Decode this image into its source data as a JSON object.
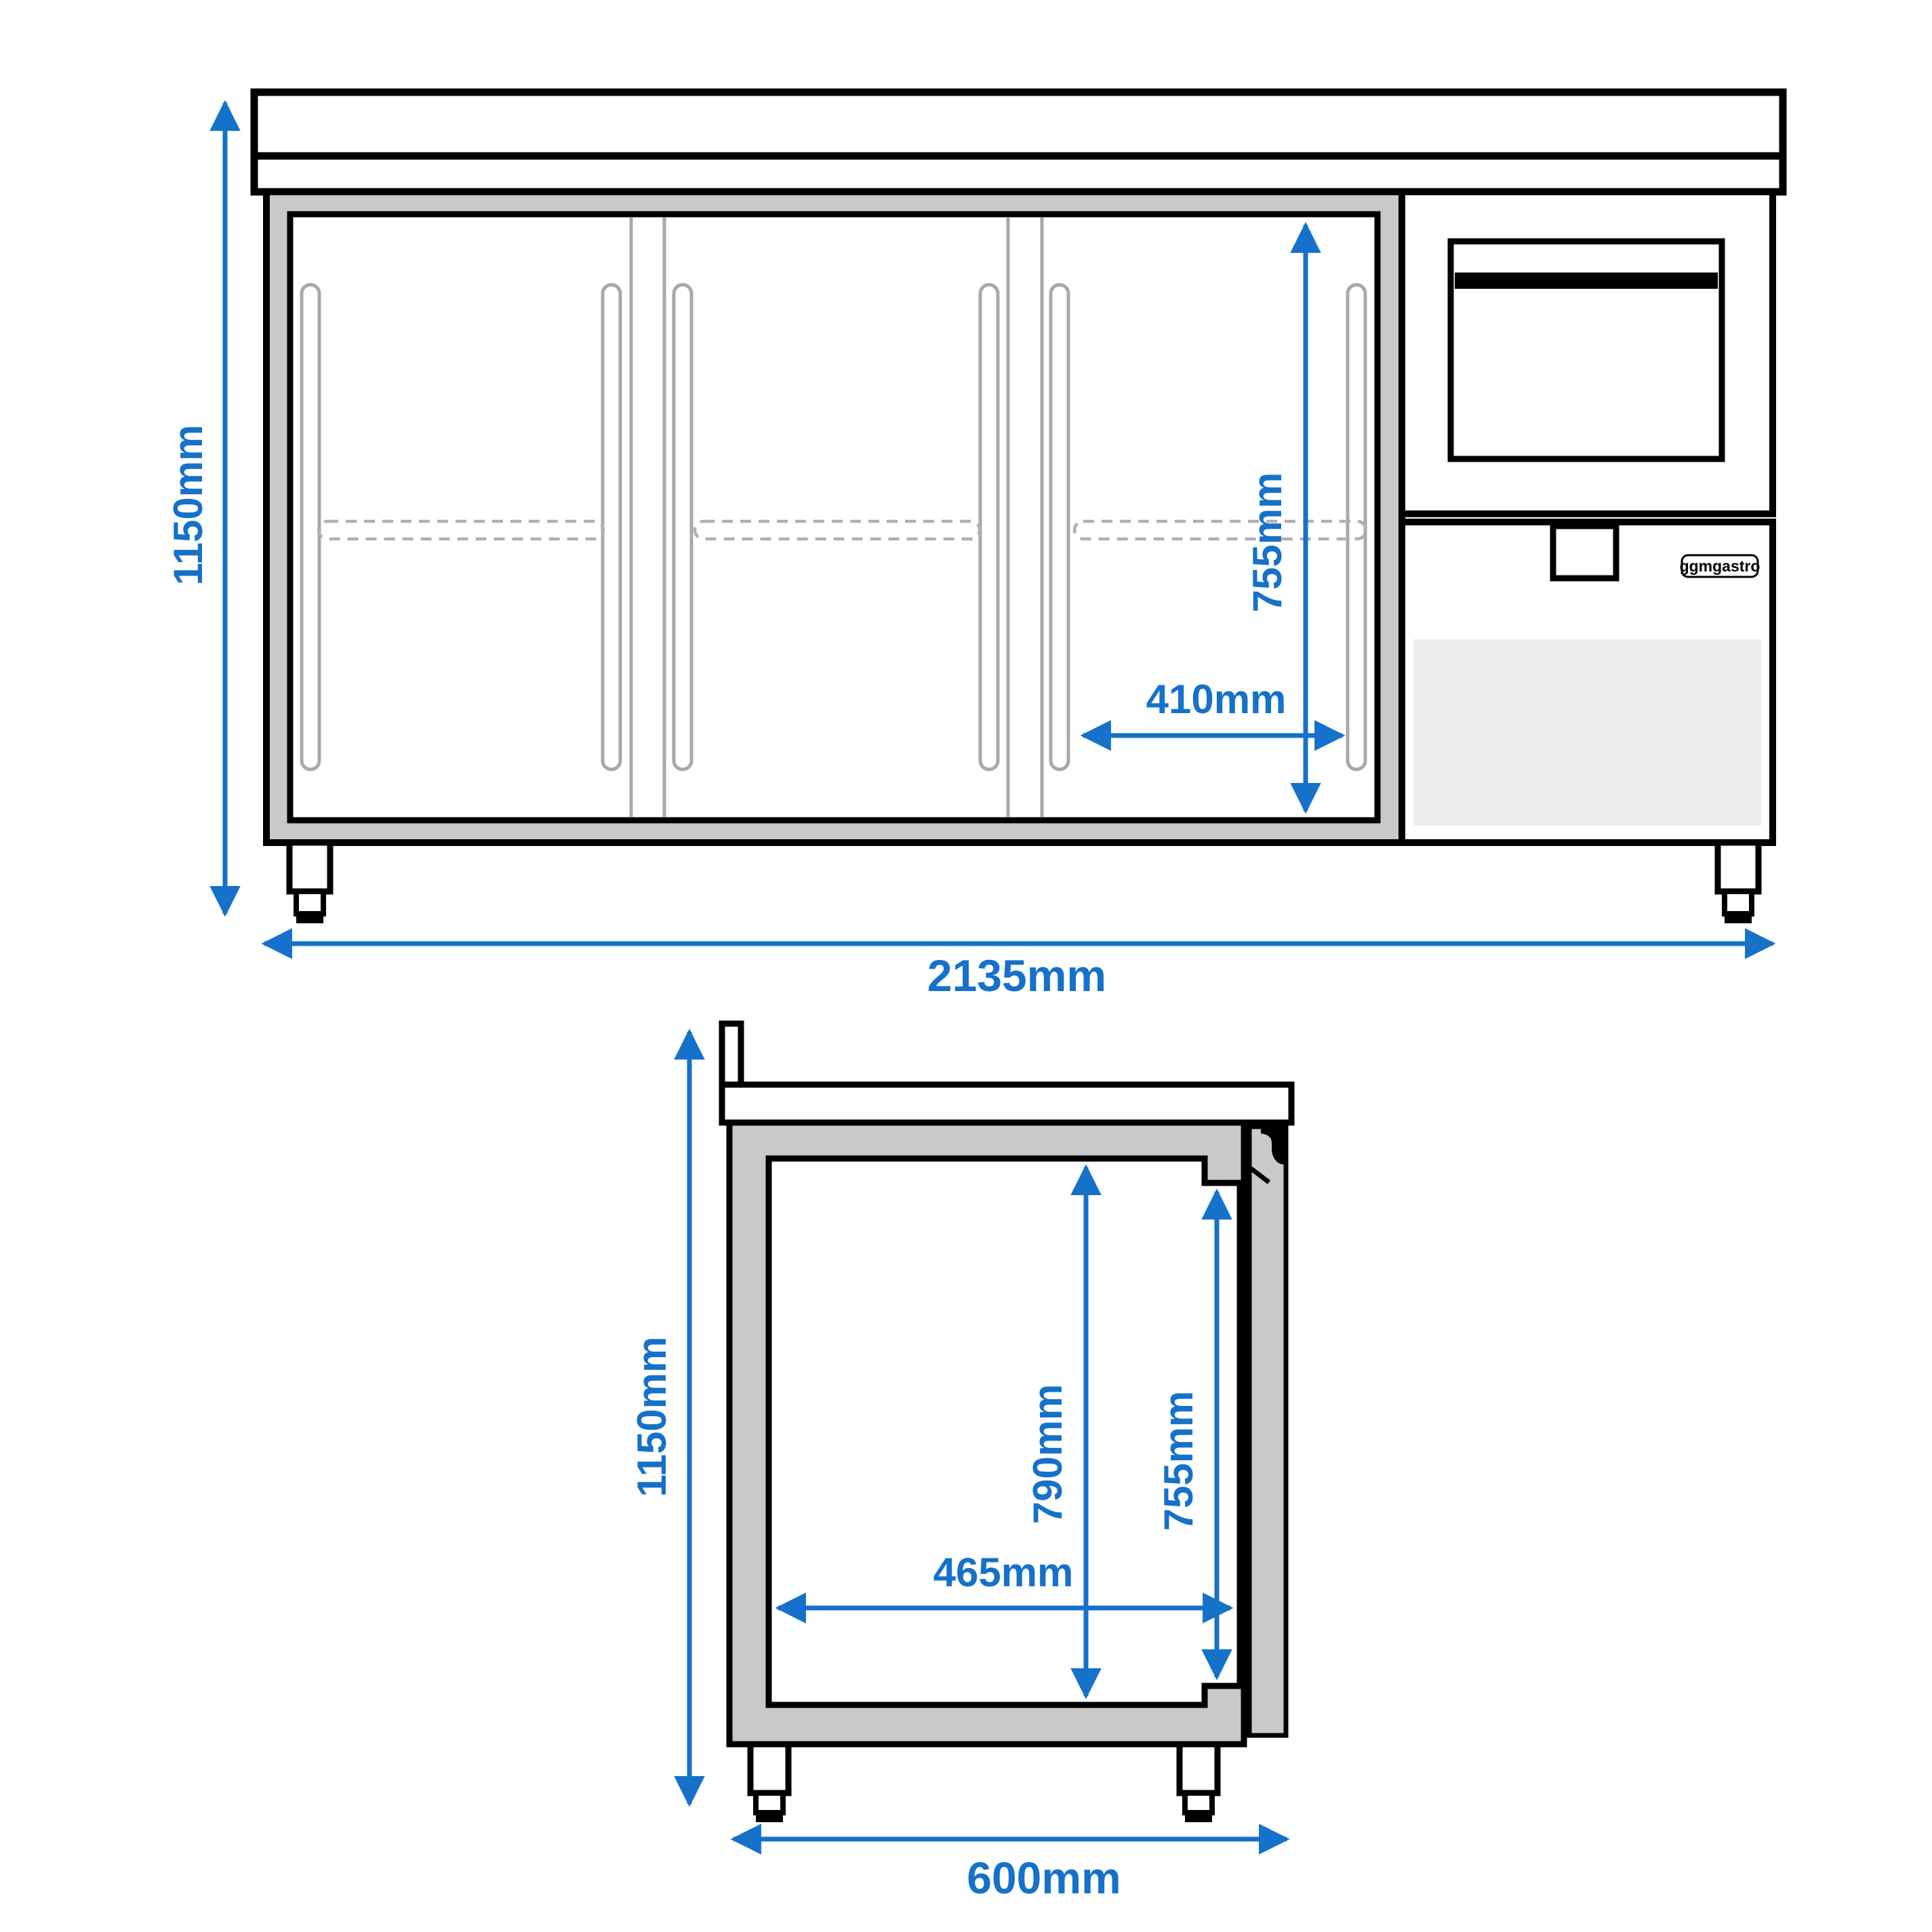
{
  "colors": {
    "accent_blue": "#1571c9",
    "cabinet_gray": "#c9c9c9",
    "panel_light_gray": "#ededed",
    "detail_gray": "#a8a8a8",
    "dash_gray": "#b0b0b0",
    "outline_black": "#000000"
  },
  "brand": {
    "logo": "ggmgastro"
  },
  "front_view": {
    "labels": {
      "overall_height": "1150mm",
      "overall_width": "2135mm",
      "door_inner_height": "755mm",
      "door_inner_width": "410mm"
    }
  },
  "side_view": {
    "labels": {
      "overall_height": "1150mm",
      "overall_depth": "600mm",
      "inner_height_back": "790mm",
      "inner_height_front": "755mm",
      "inner_depth": "465mm"
    }
  }
}
